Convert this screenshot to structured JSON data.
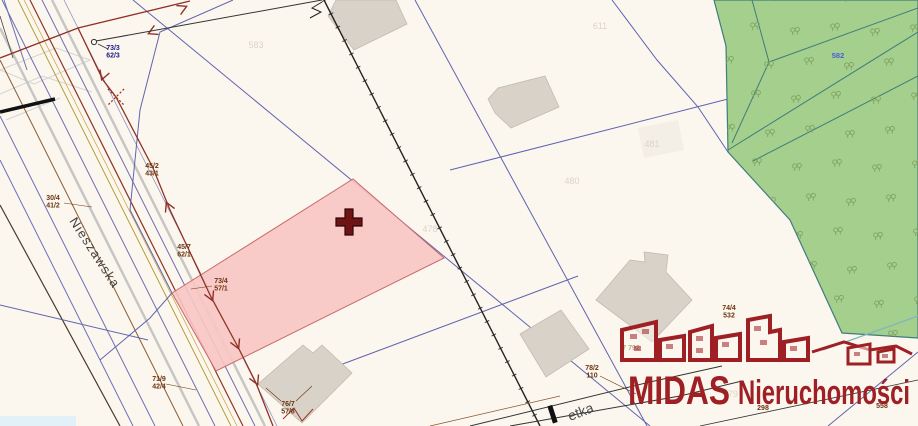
{
  "map": {
    "street_name": "Nieszawska",
    "street_name_partial": "etka",
    "forest_parcel_label": "582",
    "survey_labels": [
      {
        "line1": "73/3",
        "line2": "62/3"
      },
      {
        "line1": "30/4",
        "line2": "41/2"
      },
      {
        "line1": "45/2",
        "line2": "43/1"
      },
      {
        "line1": "45/7",
        "line2": "62/1"
      },
      {
        "line1": "73/4",
        "line2": "57/1"
      },
      {
        "line1": "71/9",
        "line2": "42/4"
      },
      {
        "line1": "76/7",
        "line2": "57/8"
      },
      {
        "line1": "78/2",
        "line2": "110"
      },
      {
        "line1": "7  792",
        "line2": ""
      },
      {
        "line1": "74/4",
        "line2": "532"
      },
      {
        "line1": "558",
        "line2": ""
      },
      {
        "line1": "298",
        "line2": ""
      }
    ],
    "ghost_parcel_numbers": [
      "583",
      "611",
      "484",
      "478",
      "480",
      "481",
      "79"
    ],
    "symbols": {
      "cross_marker": "selected-parcel-cross",
      "tree": "deciduous-tree"
    },
    "colors": {
      "background": "#fcf7ee",
      "highlight_parcel": "#f8c5c3",
      "forest": "#a5cf8d",
      "parcel_line": "#5f64b0",
      "utility_line": "#8f3126",
      "logo_red": "#9e1f24"
    }
  },
  "logo": {
    "brand": "MIDAS",
    "suffix": "Nieruchomości"
  }
}
